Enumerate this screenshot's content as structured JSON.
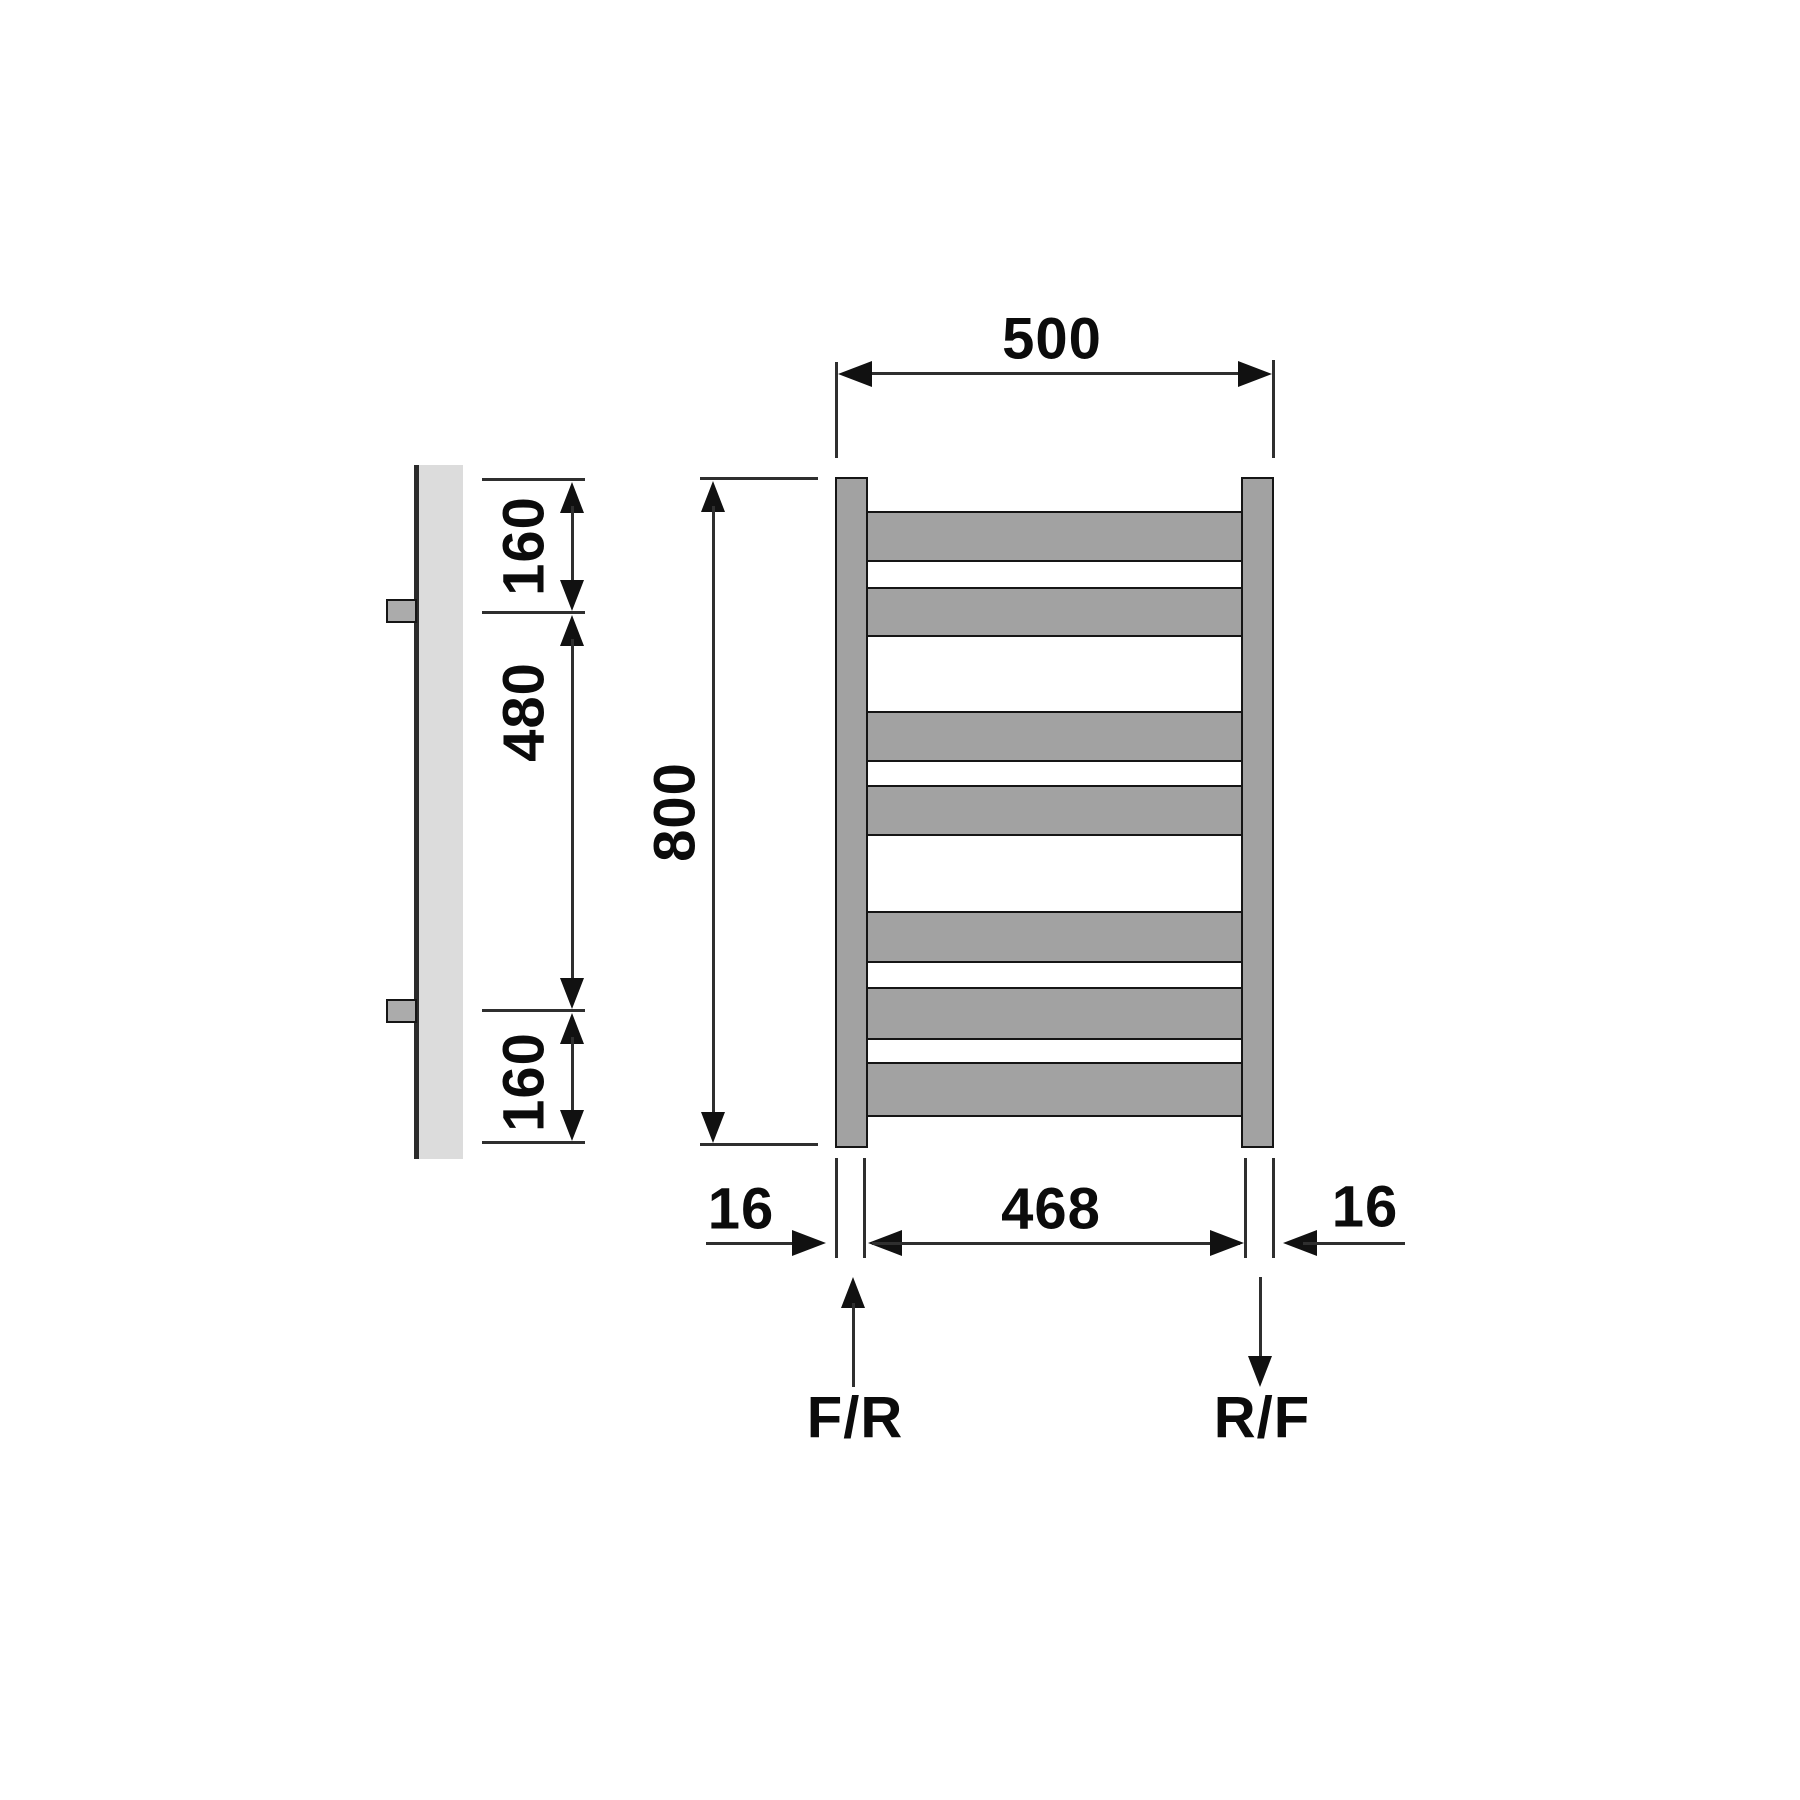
{
  "diagram": {
    "type": "technical dimensional drawing",
    "subject": "ladder-style heated towel rail radiator, front view and side view",
    "views": {
      "side_view": "vertical profile with two wall brackets",
      "front_view": "two vertical rails with 7 horizontal rungs grouped 2-2-3"
    },
    "structure": {
      "rung_count": 7,
      "side_bracket_count": 2
    }
  },
  "dimensions": {
    "overall_width": "500",
    "overall_height": "800",
    "top_connection_offset": "160",
    "connection_spacing": "480",
    "bottom_connection_offset": "160",
    "inner_rail_width": "468",
    "rail_offset_left": "16",
    "rail_offset_right": "16"
  },
  "connections": {
    "left_label": "F/R",
    "right_label": "R/F"
  },
  "colors": {
    "background": "#ffffff",
    "rail_fill": "#a2a2a2",
    "side_profile_fill": "#dcdcdc",
    "bracket_fill": "#ababab",
    "outline": "#151515",
    "dimension_line": "#2f2f2f",
    "arrowhead": "#111111",
    "text": "#0b0b0b"
  }
}
